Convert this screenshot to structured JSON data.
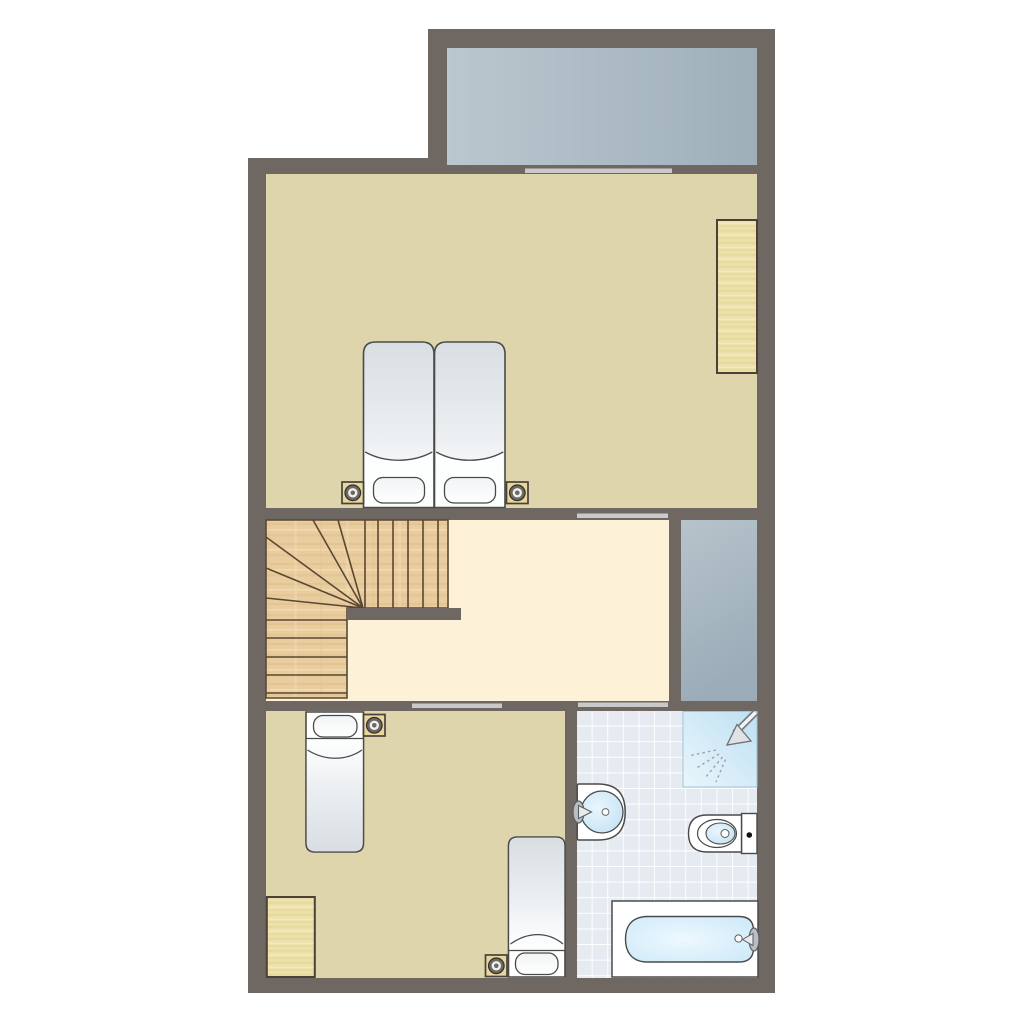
{
  "app": {
    "type": "floor-plan",
    "floor": "upper-floor",
    "text_content": "none-visible"
  },
  "palette": {
    "wall": "#6f6762",
    "bedroom_floor": "#dfd5ac",
    "landing_floor": "#fdf2d8",
    "balcony_light": "#bac7cf",
    "balcony_dark": "#9fafba",
    "void_light": "#b6c3cb",
    "void_dark": "#9bacb8",
    "stair_wood": "#e9cd9f",
    "stair_line": "#5a4832",
    "closet_wood": "#ece0ab",
    "closet_border": "#4a4238",
    "tile_base": "#e6ebf2",
    "tile_grout": "#ffffff",
    "fixture_blue": "#c8e5f6",
    "fixture_blue_light": "#eaf6fc",
    "fixture_white": "#ffffff",
    "outline": "#4a4a4a",
    "threshold": "#c9c9c9",
    "bed_shade": "#d8dee2",
    "bed_light": "#fdfefe",
    "lamp_ring": "#6e6962",
    "metal": "#b9bec2",
    "background": "#ffffff"
  },
  "rooms": [
    {
      "id": "balcony",
      "kind": "balcony-terrace",
      "furniture": []
    },
    {
      "id": "bedroom-1",
      "kind": "bedroom",
      "furniture": [
        "double-bed",
        "pillow",
        "pillow",
        "nightstand-lamp-left",
        "nightstand-lamp-right",
        "wardrobe"
      ]
    },
    {
      "id": "landing",
      "kind": "hallway-landing",
      "furniture": [
        "winder-staircase"
      ]
    },
    {
      "id": "void",
      "kind": "light-well"
    },
    {
      "id": "bedroom-2",
      "kind": "bedroom",
      "furniture": [
        "single-bed-top",
        "nightstand-lamp-1",
        "single-bed-bottom",
        "nightstand-lamp-2",
        "wardrobe"
      ]
    },
    {
      "id": "bathroom",
      "kind": "bathroom",
      "furniture": [
        "shower",
        "washbasin",
        "toilet",
        "bathtub"
      ]
    }
  ],
  "doors": [
    {
      "id": "balcony-sliding-door",
      "between": [
        "bedroom-1",
        "balcony"
      ]
    },
    {
      "id": "bedroom-1-door",
      "between": [
        "bedroom-1",
        "landing"
      ]
    },
    {
      "id": "bedroom-2-door",
      "between": [
        "landing",
        "bedroom-2"
      ]
    },
    {
      "id": "bathroom-door",
      "between": [
        "landing",
        "bathroom"
      ]
    }
  ],
  "staircase": {
    "style": "winder",
    "straight_treads_top": 6,
    "winder_treads": 6,
    "straight_treads_bottom": 5
  }
}
